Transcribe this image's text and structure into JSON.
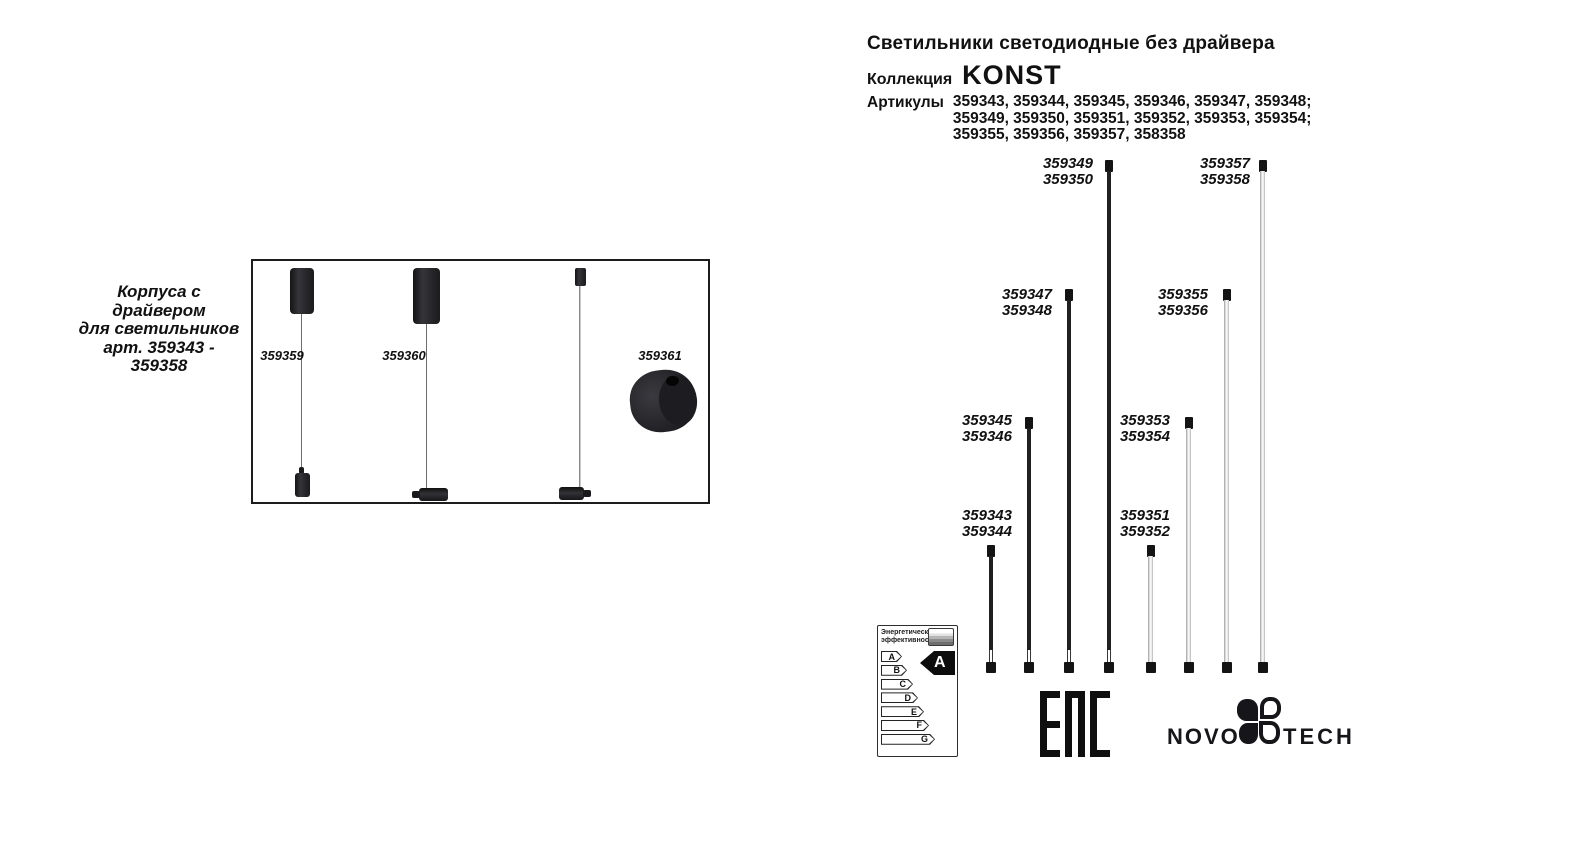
{
  "header": {
    "title": "Светильники светодиодные без драйвера",
    "collection_label": "Коллекция",
    "collection_name": "KONST",
    "articles_label": "Артикулы",
    "articles_line1": "359343, 359344, 359345, 359346, 359347, 359348;",
    "articles_line2": "359349, 359350, 359351, 359352, 359353, 359354;",
    "articles_line3": "359355, 359356, 359357, 358358"
  },
  "driver_kit_box": {
    "annotation_line1": "Корпуса с драйвером",
    "annotation_line2": "для светильников",
    "annotation_line3": "арт. 359343 - 359358",
    "item1_label": "359359",
    "item2_label": "359360",
    "item3_label": "359361"
  },
  "tubes": [
    {
      "line1": "359343",
      "line2": "359344",
      "finish": "black"
    },
    {
      "line1": "359345",
      "line2": "359346",
      "finish": "black"
    },
    {
      "line1": "359347",
      "line2": "359348",
      "finish": "black"
    },
    {
      "line1": "359349",
      "line2": "359350",
      "finish": "black"
    },
    {
      "line1": "359351",
      "line2": "359352",
      "finish": "white"
    },
    {
      "line1": "359353",
      "line2": "359354",
      "finish": "white"
    },
    {
      "line1": "359355",
      "line2": "359356",
      "finish": "white"
    },
    {
      "line1": "359357",
      "line2": "359358",
      "finish": "white"
    }
  ],
  "energy_label": {
    "title_line1": "Энергетическая",
    "title_line2": "эффективность",
    "classes": [
      "A",
      "B",
      "C",
      "D",
      "E",
      "F",
      "G"
    ],
    "rating": "A"
  },
  "logos": {
    "eac": "ЕАС",
    "brand_left": "NOVO",
    "brand_right": "TECH"
  },
  "colors": {
    "ink": "#111111",
    "tube_dark": "#202022",
    "tube_light": "#e8e8e8"
  }
}
